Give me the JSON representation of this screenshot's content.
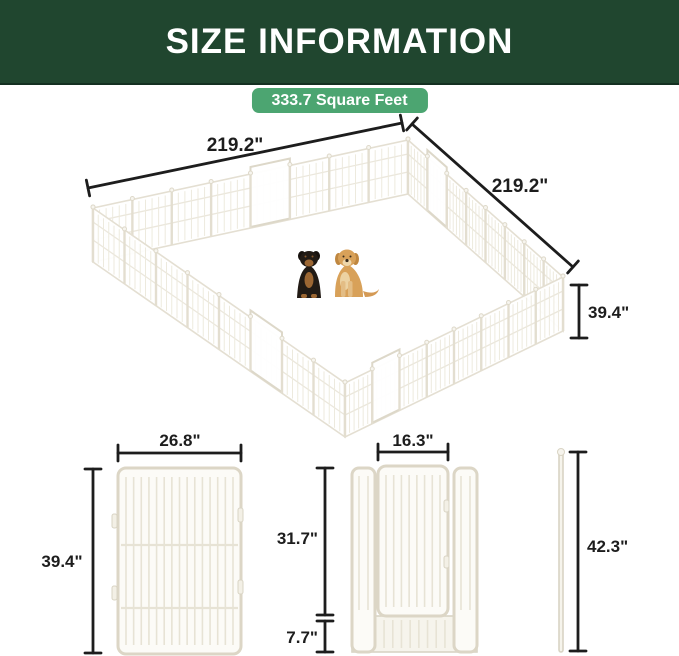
{
  "header": {
    "title": "SIZE INFORMATION"
  },
  "area_badge": {
    "label": "333.7 Square Feet"
  },
  "pen": {
    "left_length": "219.2\"",
    "right_length": "219.2\"",
    "height": "39.4\"",
    "animals": [
      "rottweiler",
      "golden-retriever"
    ]
  },
  "panel": {
    "width": "26.8\"",
    "height": "39.4\""
  },
  "door_panel": {
    "door_width": "16.3\"",
    "door_height": "31.7\"",
    "bottom_gap": "7.7\""
  },
  "ground_stake": {
    "height": "42.3\""
  },
  "colors": {
    "header_bg": "#20462f",
    "badge_bg": "#4ca571",
    "dimension_text": "#1d1d1d",
    "fence": "#e4dfd2"
  }
}
